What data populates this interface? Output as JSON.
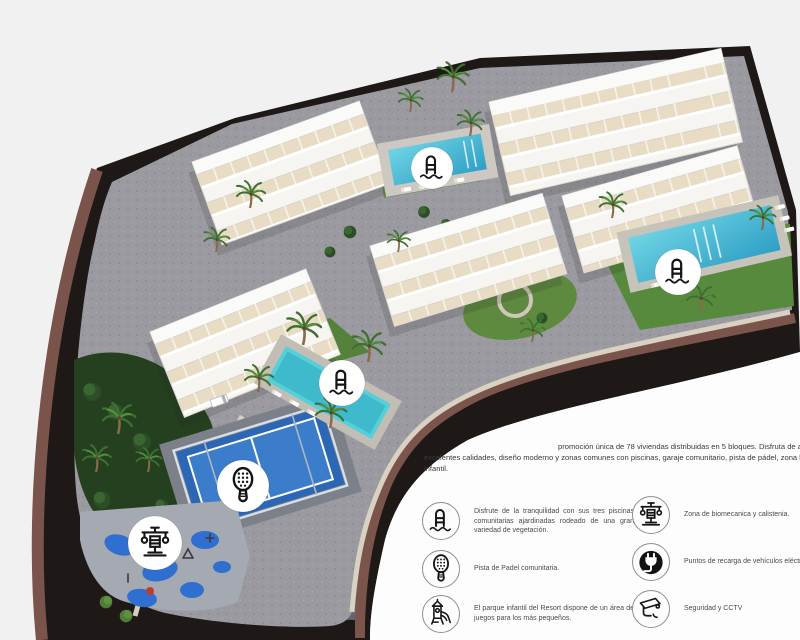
{
  "intro": {
    "line1": "promoción única de 78 viviendas distribuidas en 5 bloques. Disfruta de am",
    "line2": "excelentes calidades, diseño moderno y zonas comunes con piscinas, garaje comunitario, pista de pádel, zona biosal",
    "line3": "infantil."
  },
  "legend": {
    "left": [
      {
        "icon": "pool-icon",
        "text": "Disfrute de la tranquilidad con sus tres piscinas comunitarias ajardinadas rodeado de una gran variedad de vegetación."
      },
      {
        "icon": "padel-icon",
        "text": "Pista de Padel comunitaria."
      },
      {
        "icon": "playground-icon",
        "text": "El parque infantil del Resort dispone de un área de juegos para los más pequeños."
      }
    ],
    "right": [
      {
        "icon": "calisthenics-icon",
        "text": "Zona de biomecanica y calistenia."
      },
      {
        "icon": "ev-charger-icon",
        "text": "Puntos de recarga de vehículos eléctricos"
      },
      {
        "icon": "cctv-icon",
        "text": "Seguridad y CCTV"
      }
    ]
  },
  "map": {
    "markers": [
      {
        "name": "pool-marker-top"
      },
      {
        "name": "pool-marker-right"
      },
      {
        "name": "pool-marker-left"
      },
      {
        "name": "padel-marker"
      },
      {
        "name": "calisthenics-marker"
      }
    ],
    "features": [
      "5 apartment blocks",
      "3 community pools",
      "padel court",
      "playground",
      "calisthenics zone",
      "gardens"
    ]
  },
  "colors": {
    "background": "#f1f1f2",
    "cliff_dark": "#1e1817",
    "embankment_brown": "#7a544b",
    "paving_gray": "#97979c",
    "lawn_green": "#578a3c",
    "pool_blue": "#4fc0d8",
    "padel_blue": "#2b67b5",
    "playground_blue": "#2e6fd0"
  }
}
